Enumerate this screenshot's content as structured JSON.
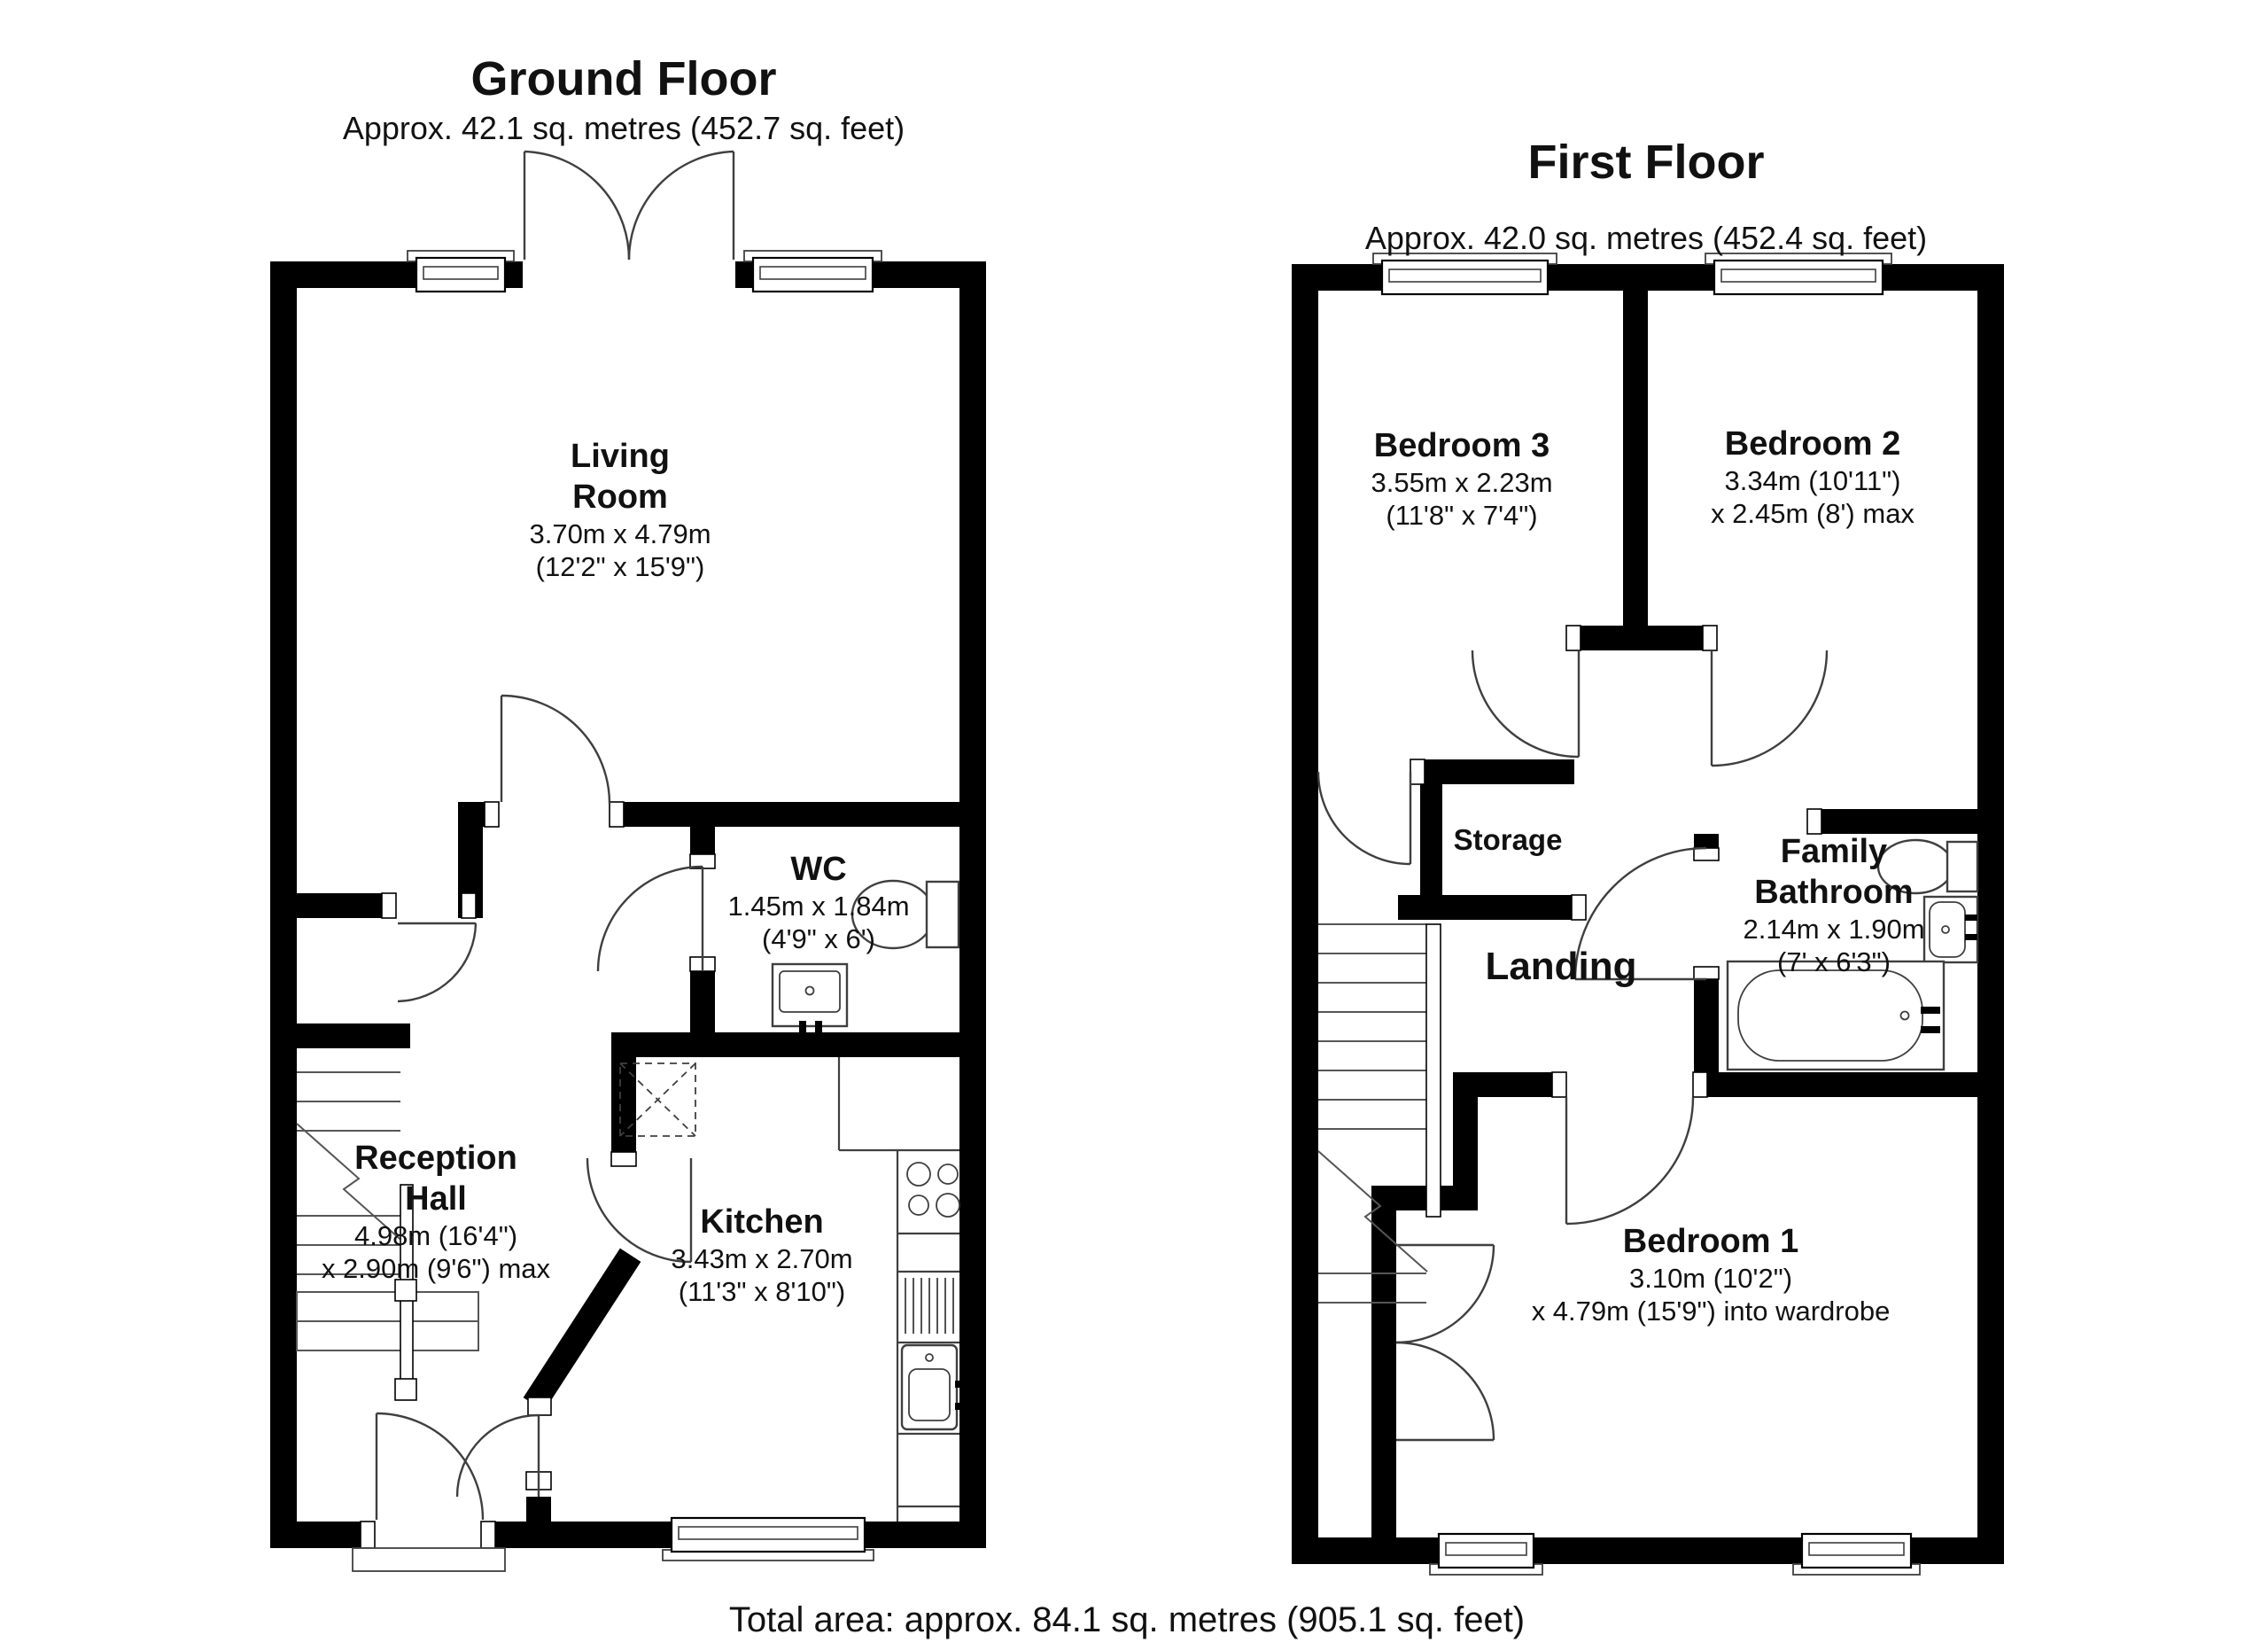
{
  "colors": {
    "ink": "#000000",
    "line": "#3f3f3f",
    "paper": "#ffffff"
  },
  "ground_floor": {
    "title": "Ground Floor",
    "subtitle": "Approx. 42.1 sq. metres (452.7 sq. feet)",
    "rooms": {
      "living": {
        "lines": [
          "Living",
          "Room",
          "3.70m x 4.79m",
          "(12'2\" x 15'9\")"
        ]
      },
      "wc": {
        "lines": [
          "WC",
          "1.45m x 1.84m",
          "(4'9\" x 6')"
        ]
      },
      "reception": {
        "lines": [
          "Reception",
          "Hall",
          "4.98m (16'4\")",
          "x 2.90m (9'6\") max"
        ]
      },
      "kitchen": {
        "lines": [
          "Kitchen",
          "3.43m x 2.70m",
          "(11'3\" x 8'10\")"
        ]
      }
    }
  },
  "first_floor": {
    "title": "First Floor",
    "subtitle": "Approx. 42.0 sq. metres (452.4 sq. feet)",
    "rooms": {
      "bedroom3": {
        "lines": [
          "Bedroom 3",
          "3.55m x 2.23m",
          "(11'8\" x 7'4\")"
        ]
      },
      "bedroom2": {
        "lines": [
          "Bedroom 2",
          "3.34m (10'11\")",
          "x 2.45m (8') max"
        ]
      },
      "storage": {
        "lines": [
          "Storage"
        ]
      },
      "landing": {
        "lines": [
          "Landing"
        ]
      },
      "bathroom": {
        "lines": [
          "Family",
          "Bathroom",
          "2.14m x 1.90m",
          "(7' x 6'3\")"
        ]
      },
      "bedroom1": {
        "lines": [
          "Bedroom 1",
          "3.10m (10'2\")",
          "x 4.79m (15'9\") into wardrobe"
        ]
      }
    }
  },
  "footer": {
    "total": "Total area: approx. 84.1 sq. metres (905.1 sq. feet)"
  }
}
